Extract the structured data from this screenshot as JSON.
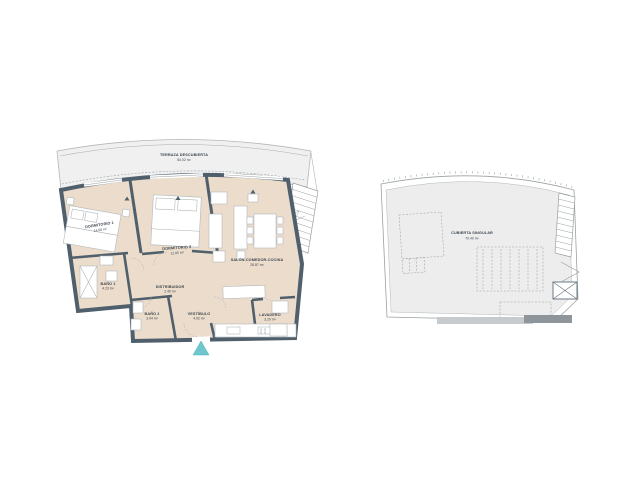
{
  "palette": {
    "wall": "#4f5f6b",
    "floor": "#ecdccb",
    "terrace_fill": "#f0f0f0",
    "roof_fill": "#ededed",
    "accent_entrance": "#6fc6ce",
    "line_gray": "#a9aeb1",
    "text": "#3d4750"
  },
  "floor_plan": {
    "terrace": {
      "label": "TERRAZA DESCUBIERTA",
      "area": "84.02 m²"
    },
    "rooms": [
      {
        "id": "dormitorio-1",
        "label": "DORMITORIO 1",
        "area": "14.08 m²"
      },
      {
        "id": "dormitorio-2",
        "label": "DORMITORIO 2",
        "area": "12.05 m²"
      },
      {
        "id": "salon-comedor-cocina",
        "label": "SALÓN-COMEDOR-COCINA",
        "area": "28.87 m²"
      },
      {
        "id": "bano-1",
        "label": "BAÑO 1",
        "area": "4.23 m²"
      },
      {
        "id": "bano-2",
        "label": "BAÑO 2",
        "area": "3.94 m²"
      },
      {
        "id": "distribuidor",
        "label": "DISTRIBUIDOR",
        "area": "2.40 m²"
      },
      {
        "id": "vestibulo",
        "label": "VESTÍBULO",
        "area": "4.92 m²"
      },
      {
        "id": "lavadero",
        "label": "LAVADERO",
        "area": "3.29 m²"
      }
    ]
  },
  "roof_plan": {
    "label": "CUBIERTA SINGULAR",
    "area": "70.40 m²"
  }
}
